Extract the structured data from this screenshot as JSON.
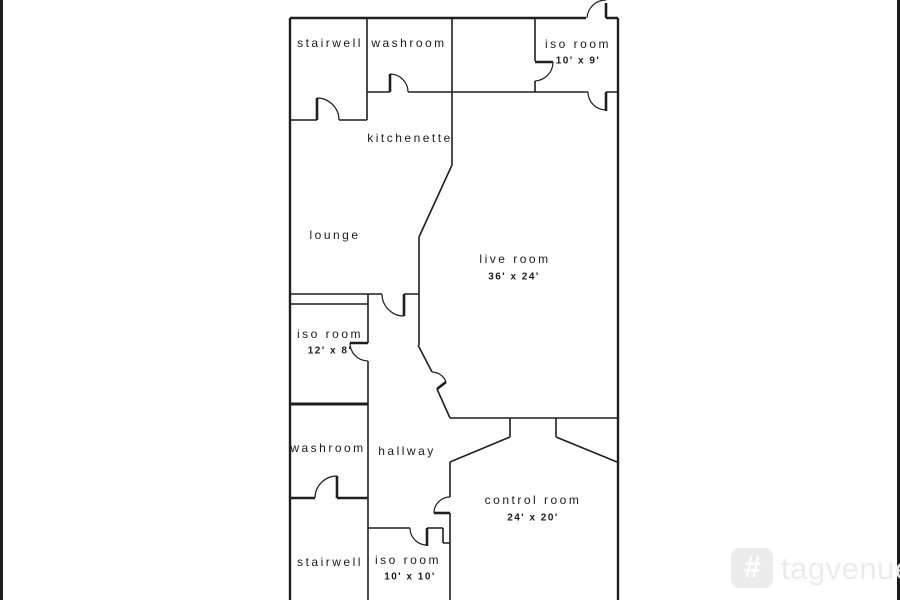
{
  "canvas": {
    "width": 900,
    "height": 600,
    "background_color": "#ffffff",
    "wall_color": "#1f1f1f",
    "edge_bar_color": "#1c1c1c"
  },
  "floorplan": {
    "rooms": [
      {
        "id": "stairwell-top",
        "label": "stairwell",
        "x": 330,
        "y": 43
      },
      {
        "id": "washroom-top",
        "label": "washroom",
        "x": 409,
        "y": 43
      },
      {
        "id": "iso-room-top",
        "label": "iso room",
        "x": 578,
        "y": 44,
        "dim": "10' x 9'",
        "dim_x": 578,
        "dim_y": 61
      },
      {
        "id": "kitchenette",
        "label": "kitchenette",
        "x": 410,
        "y": 138
      },
      {
        "id": "lounge",
        "label": "lounge",
        "x": 335,
        "y": 235
      },
      {
        "id": "live-room",
        "label": "live room",
        "x": 515,
        "y": 259,
        "dim": "36' x 24'",
        "dim_x": 514,
        "dim_y": 277
      },
      {
        "id": "iso-room-mid",
        "label": "iso room",
        "x": 330,
        "y": 334,
        "dim": "12' x 8'",
        "dim_x": 330,
        "dim_y": 351
      },
      {
        "id": "washroom-low",
        "label": "washroom",
        "x": 328,
        "y": 448
      },
      {
        "id": "hallway",
        "label": "hallway",
        "x": 407,
        "y": 451
      },
      {
        "id": "control-room",
        "label": "control room",
        "x": 533,
        "y": 500,
        "dim": "24' x 20'",
        "dim_x": 533,
        "dim_y": 518
      },
      {
        "id": "stairwell-low",
        "label": "stairwell",
        "x": 330,
        "y": 562
      },
      {
        "id": "iso-room-low",
        "label": "iso room",
        "x": 408,
        "y": 560,
        "dim": "10' x 10'",
        "dim_x": 410,
        "dim_y": 577
      }
    ]
  },
  "watermark": {
    "brand": "tagvenue",
    "logo_glyph": "#",
    "color": "#ececec"
  }
}
